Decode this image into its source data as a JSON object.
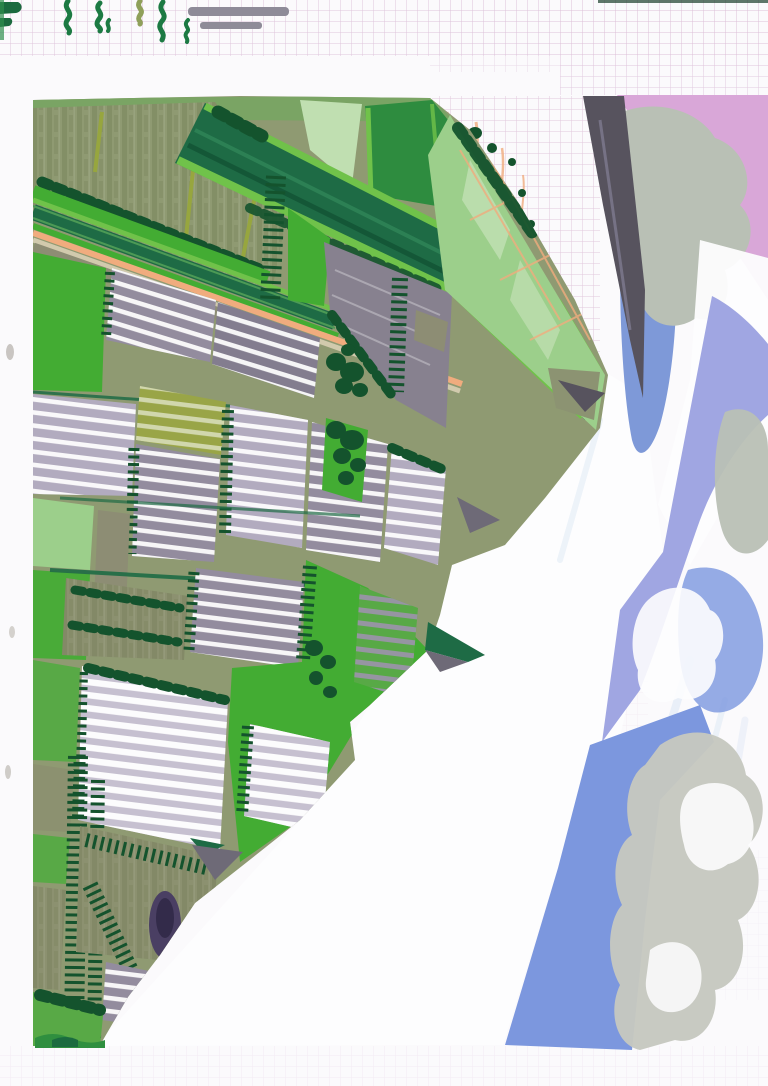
{
  "artwork": {
    "description": "Scan of a hand-painted aerial landscape in marker and gouache on graph paper: striped greenhouse fields and green farmland strips meet a white diagonal beach, a dark jetty road, and a sea-sky band of pink, blue and lavender with grey clouds. Marker test squiggles and two grey bars are scribbled on the grid paper margin at the top.",
    "visible_text": ""
  },
  "paper": {
    "grid_size_px": 11
  },
  "palette": {
    "paper": "#fbfafc",
    "grid": "#dcbfd8",
    "grid_dark": "#c7b4cd",
    "margin": "#f6f5f3",
    "wash": "#7aa464",
    "sage": "#8f9a72",
    "olive_field": "#8c9170",
    "bright": "#43ac33",
    "mid": "#58a946",
    "mid_dark": "#2e8c3f",
    "light_green": "#9ccf8b",
    "pale_green": "#c0dfb1",
    "teal": "#1e6b45",
    "lime": "#70c24a",
    "dark_tree": "#14532d",
    "orange": "#f0ac7e",
    "tan": "#d8cfb4",
    "gray_olive": "#8d8d74",
    "gh_light": "#b2abbf",
    "gh_mid": "#938c9e",
    "gh_dark": "#837d8f",
    "gh_pale": "#c6c0d0",
    "yellow_green": "#99a547",
    "gray_road": "#87818f",
    "shadow": "#6e6a77",
    "dark_band": "#57535e",
    "pink": "#d9a7d8",
    "cloud": "#b9c0b5",
    "blue": "#7e99d8",
    "lavender": "#a0a6e2",
    "blue_deep": "#7c97de",
    "cloud_beige": "#c6c8bf",
    "pale_blue": "#cfdff2",
    "white_paint": "#fdfdfe",
    "purple": "#4a3f63",
    "bar_gray": "#8e8b98",
    "squiggle": "#1c7a43",
    "squiggle_olive": "#8fa05a"
  },
  "regions": {
    "top_margin": "graph paper with marker test squiggles and two grey bars",
    "farmland": "diagonal strips of sage fields, green roads, dark tree rows and an orange road",
    "greenhouses": "blocks of grey polytunnels with white stripes separated by cypress tree rows",
    "coast": "white sand band with grey shadow wedges",
    "sea_sky": "pink, blue and lavender bands with grey-green clouds"
  }
}
